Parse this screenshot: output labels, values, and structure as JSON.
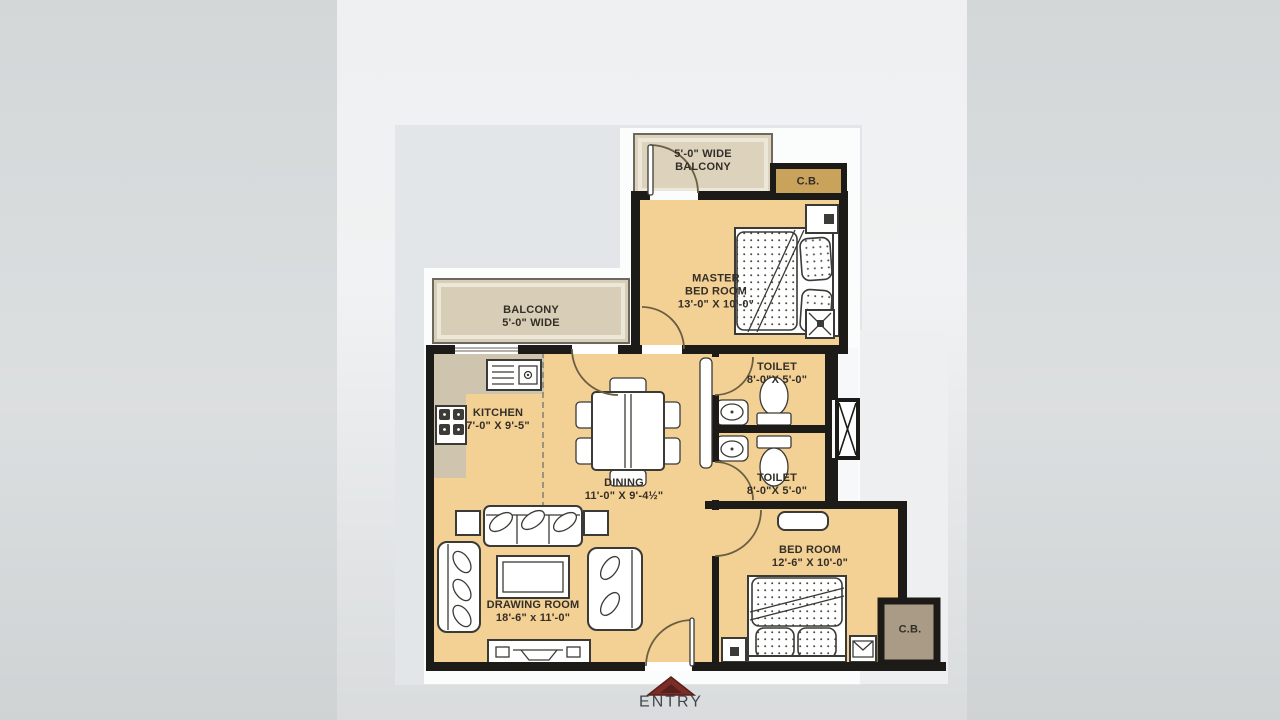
{
  "labels": {
    "balcony_top": "5'-0\" WIDE\nBALCONY",
    "cb_top": "C.B.",
    "master_bedroom": "MASTER\nBED ROOM\n13'-0\" X 10'-0\"",
    "toilet_top": "TOILET\n8'-0\"X 5'-0\"",
    "balcony_left": "BALCONY\n5'-0\" WIDE",
    "kitchen": "KITCHEN\n7'-0\" X 9'-5\"",
    "dining": "DINING\n11'-0\" X 9'-4½\"",
    "toilet_bottom": "TOILET\n8'-0\"X 5'-0\"",
    "bed_room": "BED ROOM\n12'-6\" X 10'-0\"",
    "drawing_room": "DRAWING ROOM\n18'-6\" x 11'-0\"",
    "cb_bottom": "C.B.",
    "entry": "ENTRY"
  },
  "colors": {
    "page_bg": "#d7dadb",
    "photo_bg": "#eef0f1",
    "backdrop_gray": "#e3e6e9",
    "backdrop_white": "#fbfcfc",
    "backdrop_right": "#edeff1",
    "floor": "#f3d094",
    "balcony": "#d8cdb6",
    "balcony_top_fill": "#ddd3bd",
    "counter": "#cfc4ae",
    "cb_top_fill": "#c9a35c",
    "cb_bottom_fill": "#a99b85",
    "wall": "#1d1b18",
    "entry_arrow": "#7c2d28",
    "label_text": "#332f28",
    "entry_text": "#42474e"
  }
}
